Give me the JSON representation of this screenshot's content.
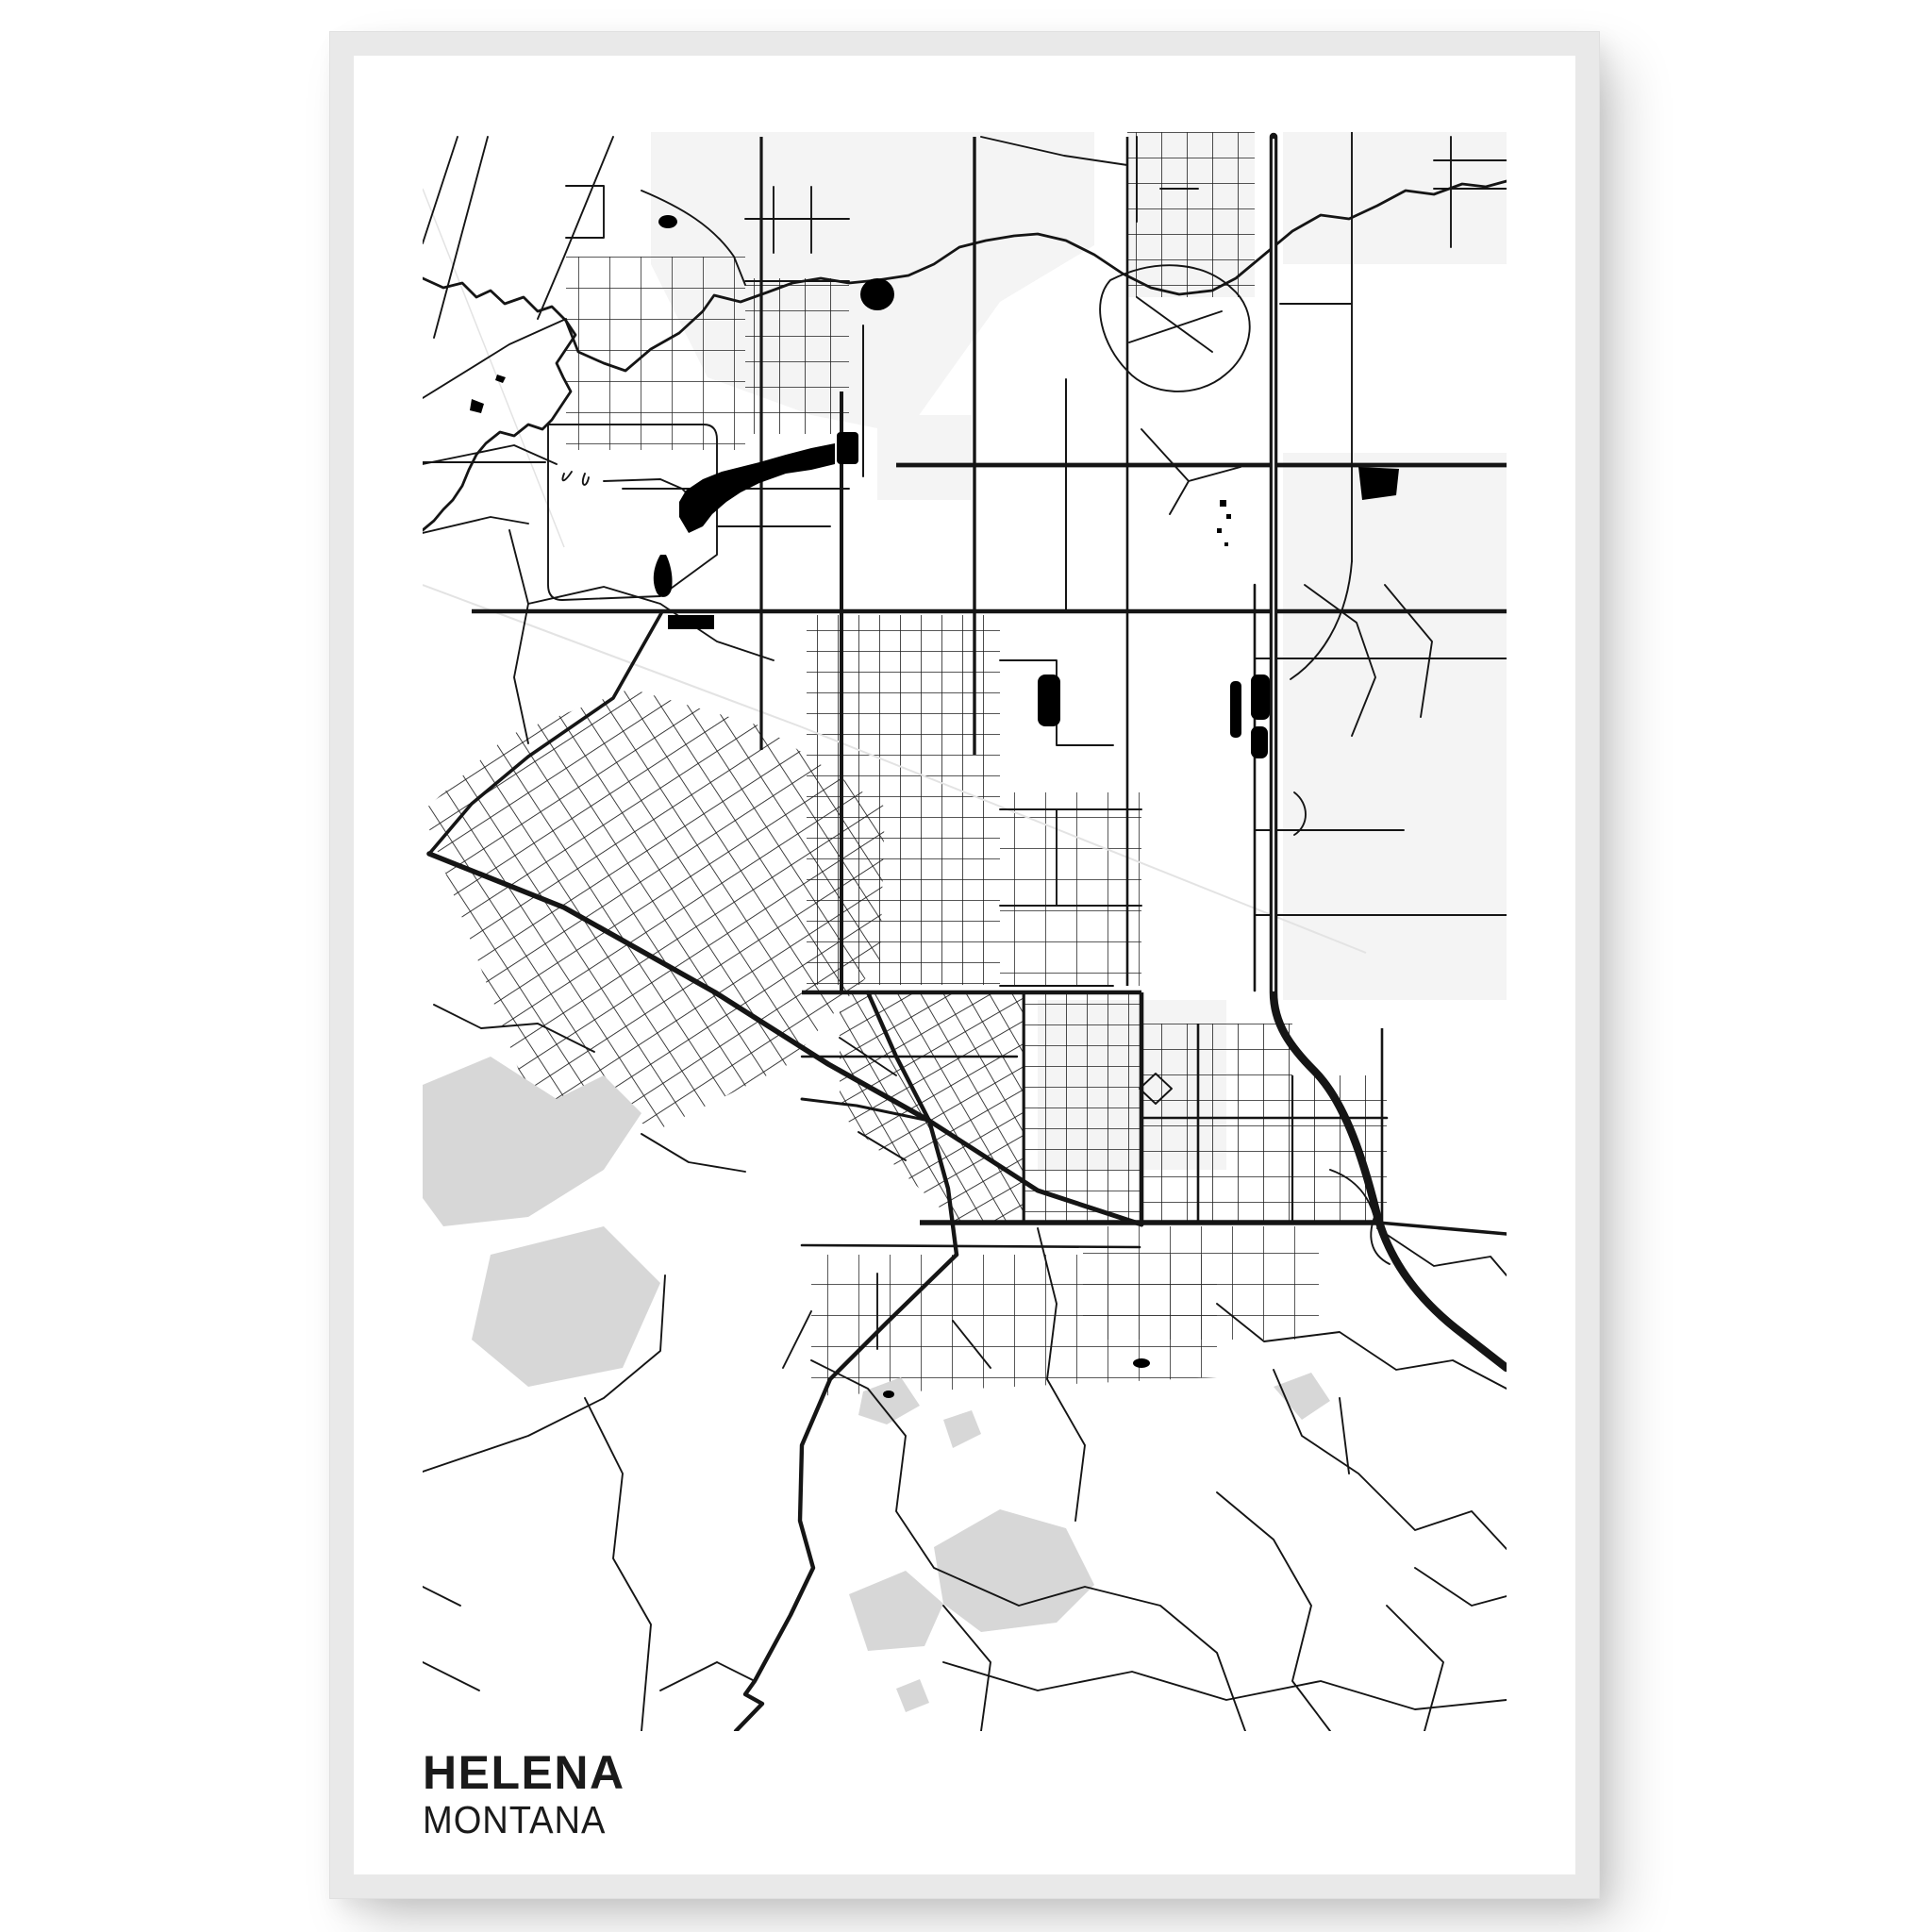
{
  "poster": {
    "title": "HELENA",
    "subtitle": "MONTANA",
    "description": "Black and white minimalist street map poster of Helena, Montana, shown in a light gray frame on a white background",
    "colors": {
      "frame": "#e9e9e9",
      "page_background": "#ffffff",
      "poster_background": "#ffffff",
      "road": "#151515",
      "water": "#000000",
      "hill": "#d7d7d7",
      "pale_area": "#f4f4f4",
      "railway": "#e3e3e3",
      "text": "#1a1a1a"
    }
  }
}
